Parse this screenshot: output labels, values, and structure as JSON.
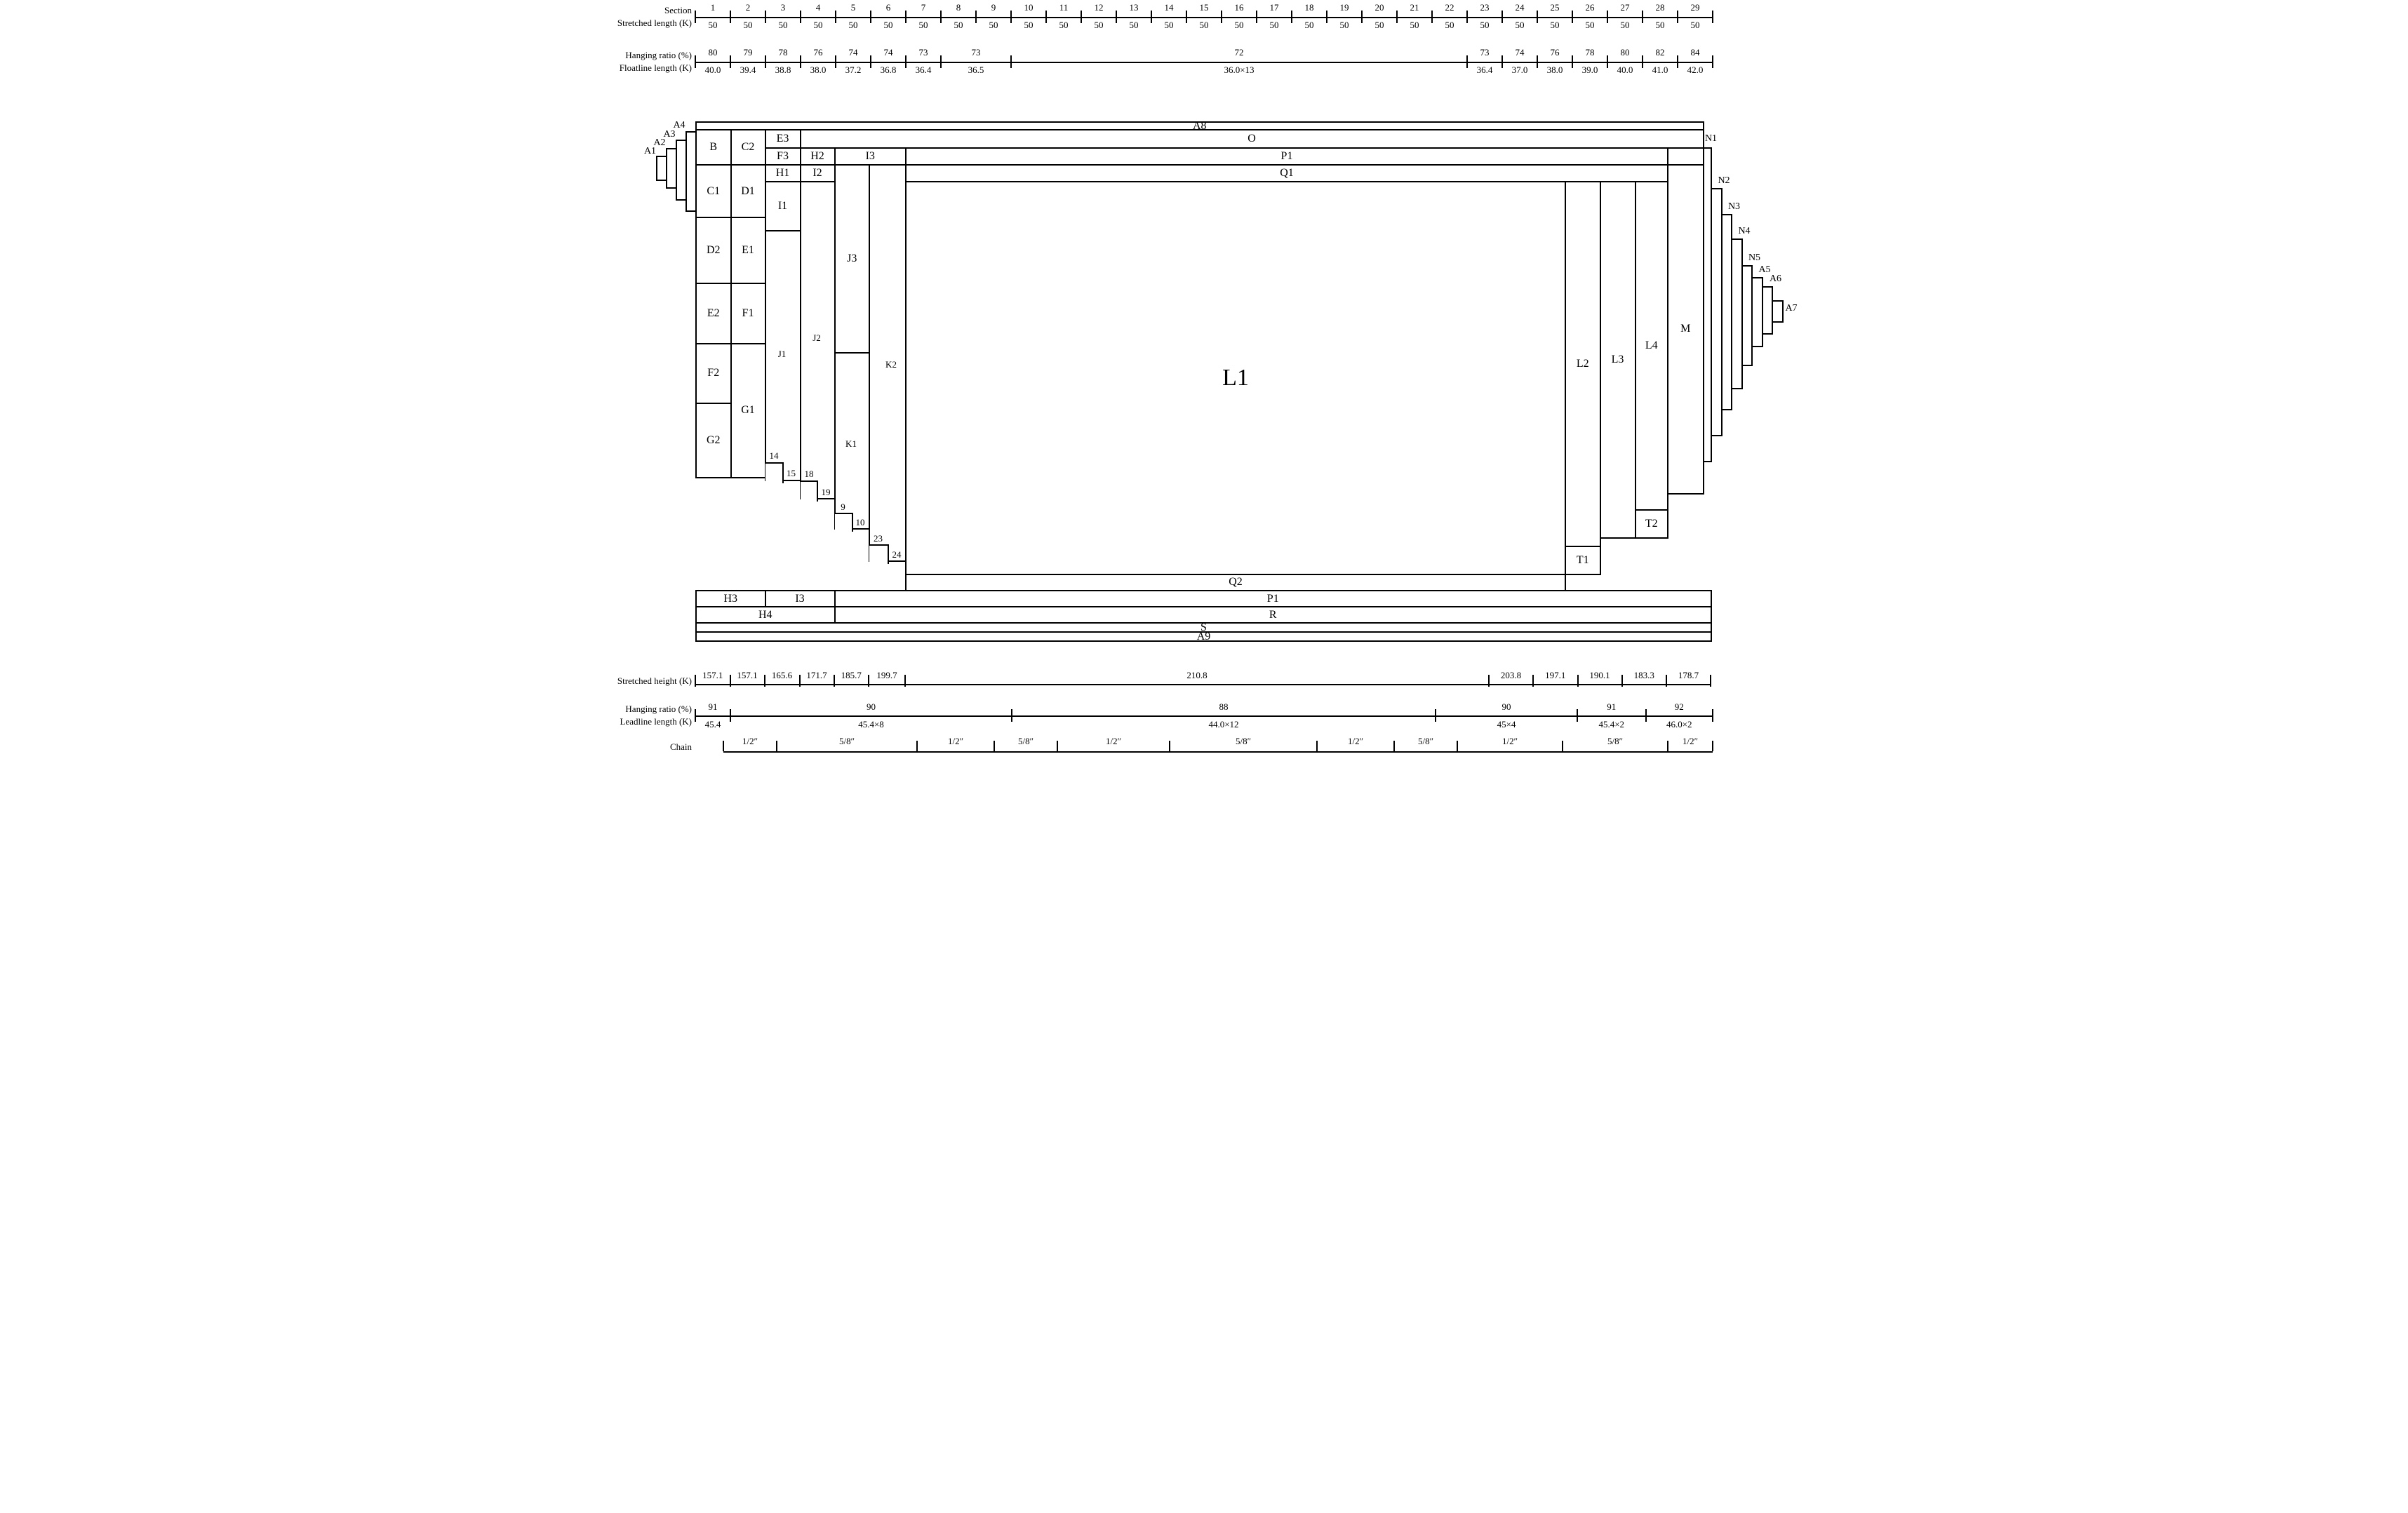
{
  "panels": {
    "A1": "A1",
    "A2": "A2",
    "A3": "A3",
    "A4": "A4",
    "A5": "A5",
    "A6": "A6",
    "A7": "A7",
    "A8": "A8",
    "A9": "A9",
    "B": "B",
    "C1": "C1",
    "C2": "C2",
    "D1": "D1",
    "D2": "D2",
    "E1": "E1",
    "E2": "E2",
    "E3": "E3",
    "F1": "F1",
    "F2": "F2",
    "F3": "F3",
    "G1": "G1",
    "G2": "G2",
    "H1": "H1",
    "H2": "H2",
    "H3": "H3",
    "H4": "H4",
    "I1": "I1",
    "I2": "I2",
    "I3": "I3",
    "J1": "J1",
    "J2": "J2",
    "J3": "J3",
    "K1": "K1",
    "K2": "K2",
    "L1": "L1",
    "L2": "L2",
    "L3": "L3",
    "L4": "L4",
    "M": "M",
    "N1": "N1",
    "N2": "N2",
    "N3": "N3",
    "N4": "N4",
    "N5": "N5",
    "O": "O",
    "P1": "P1",
    "Q1": "Q1",
    "Q2": "Q2",
    "R": "R",
    "S": "S",
    "T1": "T1",
    "T2": "T2"
  },
  "steps": {
    "s14": "14",
    "s15": "15",
    "s18": "18",
    "s19": "19",
    "s9": "9",
    "s10": "10",
    "s23": "23",
    "s24": "24"
  },
  "rulers": {
    "section": {
      "label_top": "Section",
      "label_bottom": "Stretched length (K)",
      "sections": [
        {
          "no": "1",
          "len": "50"
        },
        {
          "no": "2",
          "len": "50"
        },
        {
          "no": "3",
          "len": "50"
        },
        {
          "no": "4",
          "len": "50"
        },
        {
          "no": "5",
          "len": "50"
        },
        {
          "no": "6",
          "len": "50"
        },
        {
          "no": "7",
          "len": "50"
        },
        {
          "no": "8",
          "len": "50"
        },
        {
          "no": "9",
          "len": "50"
        },
        {
          "no": "10",
          "len": "50"
        },
        {
          "no": "11",
          "len": "50"
        },
        {
          "no": "12",
          "len": "50"
        },
        {
          "no": "13",
          "len": "50"
        },
        {
          "no": "14",
          "len": "50"
        },
        {
          "no": "15",
          "len": "50"
        },
        {
          "no": "16",
          "len": "50"
        },
        {
          "no": "17",
          "len": "50"
        },
        {
          "no": "18",
          "len": "50"
        },
        {
          "no": "19",
          "len": "50"
        },
        {
          "no": "20",
          "len": "50"
        },
        {
          "no": "21",
          "len": "50"
        },
        {
          "no": "22",
          "len": "50"
        },
        {
          "no": "23",
          "len": "50"
        },
        {
          "no": "24",
          "len": "50"
        },
        {
          "no": "25",
          "len": "50"
        },
        {
          "no": "26",
          "len": "50"
        },
        {
          "no": "27",
          "len": "50"
        },
        {
          "no": "28",
          "len": "50"
        },
        {
          "no": "29",
          "len": "50"
        }
      ]
    },
    "top_hanging": {
      "label_top": "Hanging ratio (%)",
      "label_bottom": "Floatline length (K)",
      "segments": [
        {
          "from": 268,
          "to": 368,
          "ratio": "80",
          "length": "40.0"
        },
        {
          "from": 368,
          "to": 468,
          "ratio": "79",
          "length": "39.4"
        },
        {
          "from": 468,
          "to": 568,
          "ratio": "78",
          "length": "38.8"
        },
        {
          "from": 568,
          "to": 668,
          "ratio": "76",
          "length": "38.0"
        },
        {
          "from": 668,
          "to": 768,
          "ratio": "74",
          "length": "37.2"
        },
        {
          "from": 768,
          "to": 868,
          "ratio": "74",
          "length": "36.8"
        },
        {
          "from": 868,
          "to": 968,
          "ratio": "73",
          "length": "36.4"
        },
        {
          "from": 968,
          "to": 1168,
          "ratio": "73",
          "length": "36.5"
        },
        {
          "from": 1168,
          "to": 2468,
          "ratio": "72",
          "length": "36.0×13"
        },
        {
          "from": 2468,
          "to": 2568,
          "ratio": "73",
          "length": "36.4"
        },
        {
          "from": 2568,
          "to": 2668,
          "ratio": "74",
          "length": "37.0"
        },
        {
          "from": 2668,
          "to": 2768,
          "ratio": "76",
          "length": "38.0"
        },
        {
          "from": 2768,
          "to": 2868,
          "ratio": "78",
          "length": "39.0"
        },
        {
          "from": 2868,
          "to": 2968,
          "ratio": "80",
          "length": "40.0"
        },
        {
          "from": 2968,
          "to": 3068,
          "ratio": "82",
          "length": "41.0"
        },
        {
          "from": 3068,
          "to": 3168,
          "ratio": "84",
          "length": "42.0"
        }
      ]
    },
    "stretched_height": {
      "label": "Stretched height (K)",
      "segments": [
        {
          "from": 268,
          "to": 367,
          "value": "157.1"
        },
        {
          "from": 367,
          "to": 465,
          "value": "157.1"
        },
        {
          "from": 465,
          "to": 565,
          "value": "165.6"
        },
        {
          "from": 565,
          "to": 663,
          "value": "171.7"
        },
        {
          "from": 663,
          "to": 762,
          "value": "185.7"
        },
        {
          "from": 762,
          "to": 866,
          "value": "199.7"
        },
        {
          "from": 866,
          "to": 2530,
          "value": "210.8"
        },
        {
          "from": 2530,
          "to": 2656,
          "value": "203.8"
        },
        {
          "from": 2656,
          "to": 2783,
          "value": "197.1"
        },
        {
          "from": 2783,
          "to": 2909,
          "value": "190.1"
        },
        {
          "from": 2909,
          "to": 3036,
          "value": "183.3"
        },
        {
          "from": 3036,
          "to": 3162,
          "value": "178.7"
        }
      ]
    },
    "bottom_hanging": {
      "label_top": "Hanging ratio (%)",
      "label_bottom": "Leadline length (K)",
      "segments": [
        {
          "from": 268,
          "to": 368,
          "ratio": "91",
          "length": "45.4"
        },
        {
          "from": 368,
          "to": 1170,
          "ratio": "90",
          "length": "45.4×8"
        },
        {
          "from": 1170,
          "to": 2378,
          "ratio": "88",
          "length": "44.0×12"
        },
        {
          "from": 2378,
          "to": 2782,
          "ratio": "90",
          "length": "45×4"
        },
        {
          "from": 2782,
          "to": 2977,
          "ratio": "91",
          "length": "45.4×2"
        },
        {
          "from": 2977,
          "to": 3168,
          "ratio": "92",
          "length": "46.0×2"
        }
      ]
    },
    "chain": {
      "label": "Chain",
      "segments": [
        {
          "from": 348,
          "to": 500,
          "size": "1/2″"
        },
        {
          "from": 500,
          "to": 900,
          "size": "5/8″"
        },
        {
          "from": 900,
          "to": 1120,
          "size": "1/2″"
        },
        {
          "from": 1120,
          "to": 1300,
          "size": "5/8″"
        },
        {
          "from": 1300,
          "to": 1620,
          "size": "1/2″"
        },
        {
          "from": 1620,
          "to": 2040,
          "size": "5/8″"
        },
        {
          "from": 2040,
          "to": 2260,
          "size": "1/2″"
        },
        {
          "from": 2260,
          "to": 2440,
          "size": "5/8″"
        },
        {
          "from": 2440,
          "to": 2740,
          "size": "1/2″"
        },
        {
          "from": 2740,
          "to": 3040,
          "size": "5/8″"
        },
        {
          "from": 3040,
          "to": 3168,
          "size": "1/2″"
        }
      ]
    }
  }
}
